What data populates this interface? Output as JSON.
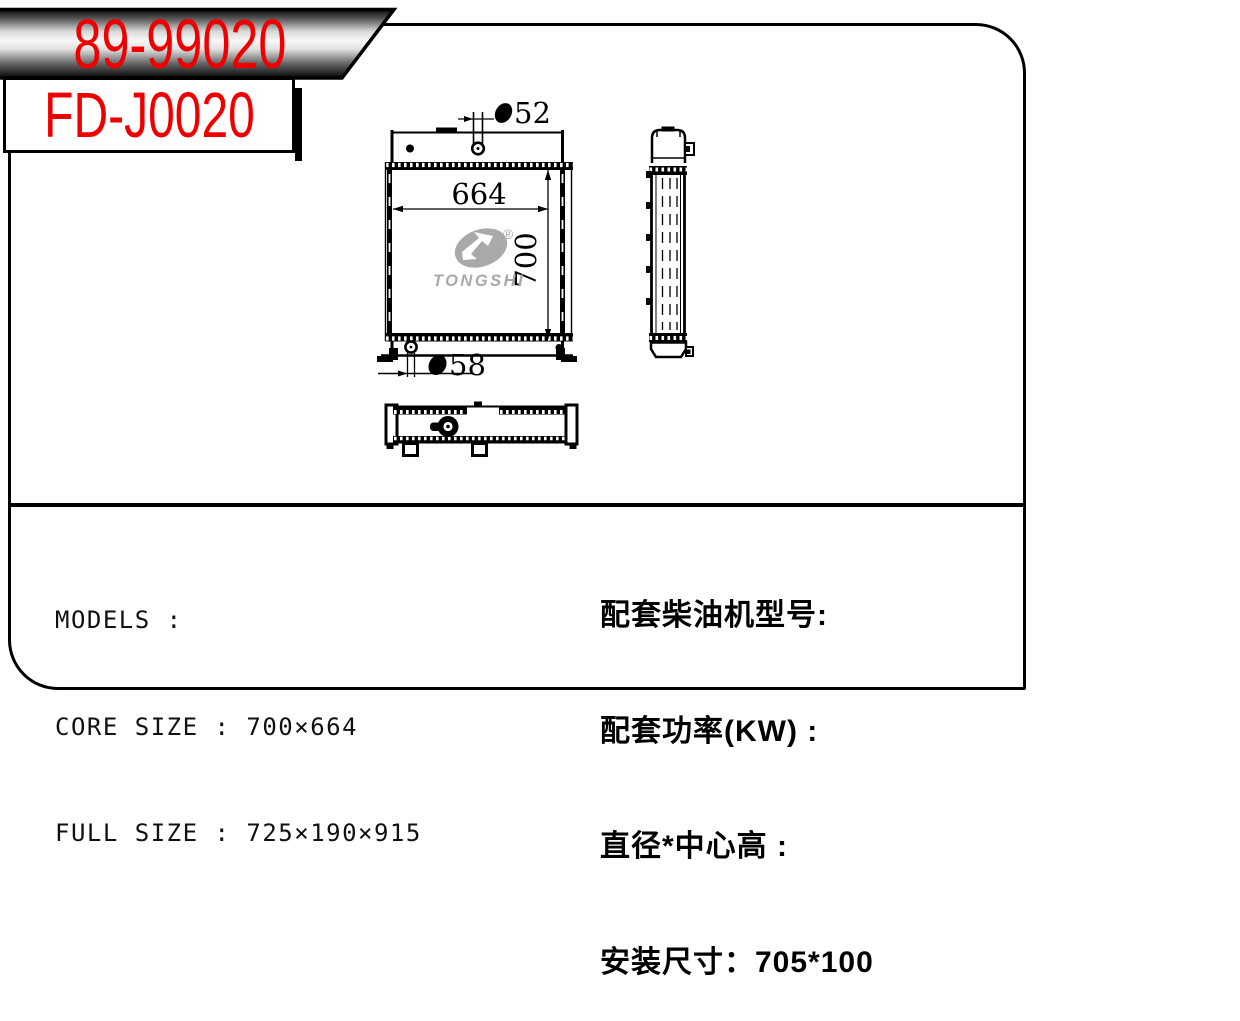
{
  "codes": {
    "model": "89-99020",
    "product": "FD-J0020"
  },
  "drawing": {
    "core_width": "664",
    "core_height": "700",
    "inlet_diameter": "52",
    "outlet_diameter": "58",
    "logo": {
      "brand": "TONGSHI",
      "registered": "®"
    }
  },
  "specs": {
    "left": [
      {
        "text": "MODELS :"
      },
      {
        "text": "CORE SIZE : 700×664"
      },
      {
        "text": "FULL SIZE : 725×190×915"
      }
    ],
    "right": [
      {
        "text": "配套柴油机型号:"
      },
      {
        "text": "配套功率(KW) :"
      },
      {
        "text": "直径*中心高 :"
      },
      {
        "text": "安装尺寸：705*100"
      }
    ]
  },
  "colors": {
    "accent_red": "#ee0000",
    "logo_gray": "#a9a9a9",
    "line_black": "#000000"
  }
}
